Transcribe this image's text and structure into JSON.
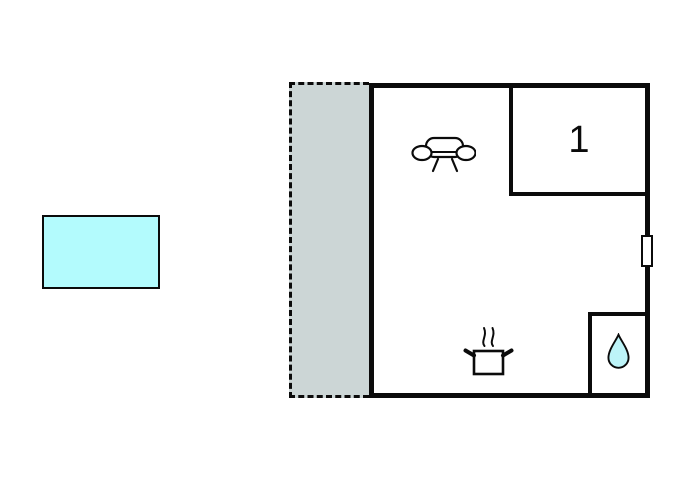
{
  "plan": {
    "room1_label": "1"
  },
  "colors": {
    "wall": "#0b0b0b",
    "terrace_fill": "#ccd6d6",
    "pool_fill": "#b3fbfd",
    "water_drop_fill": "#bdf4f8",
    "background": "#ffffff"
  },
  "icons": {
    "sofa": "sofa-icon",
    "cooking_pot": "cooking-pot-icon",
    "water_drop": "water-drop-icon",
    "door": "door-marker"
  }
}
